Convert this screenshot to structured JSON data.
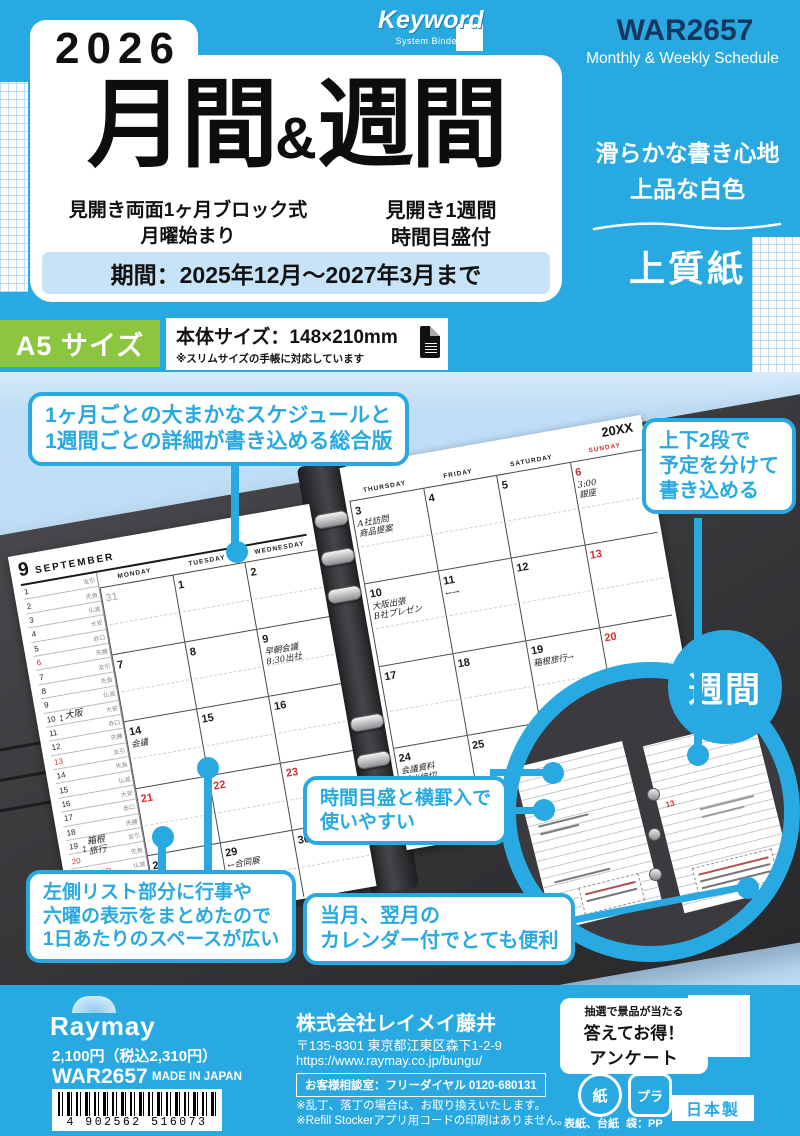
{
  "colors": {
    "accent": "#29A9E1",
    "green": "#8CC63F",
    "navy": "#17375F"
  },
  "brand": {
    "keyword": "Keyword",
    "keyword_sub": "System Binder",
    "raymay": "Raymay"
  },
  "header": {
    "year": "2026",
    "title_left": "月間",
    "title_amp": "&",
    "title_right": "週間",
    "product_code": "WAR2657",
    "product_subtitle": "Monthly & Weekly Schedule",
    "feature_left_1": "見開き両面1ヶ月ブロック式",
    "feature_left_2": "月曜始まり",
    "feature_right_1": "見開き1週間",
    "feature_right_2": "時間目盛付",
    "period": "期間：2025年12月～2027年3月まで"
  },
  "paper": {
    "line1": "滑らかな書き心地",
    "line2": "上品な白色",
    "type": "上質紙"
  },
  "size": {
    "badge": "A5 サイズ",
    "body": "本体サイズ：148×210mm",
    "note": "※スリムサイズの手帳に対応しています"
  },
  "callouts": {
    "c1": [
      "1ヶ月ごとの大まかなスケジュールと",
      "1週間ごとの詳細が書き込める総合版"
    ],
    "c2": [
      "上下2段で",
      "予定を分けて",
      "書き込める"
    ],
    "c3": [
      "時間目盛と横罫入で",
      "使いやすい"
    ],
    "c4": [
      "左側リスト部分に行事や",
      "六曜の表示をまとめたので",
      "1日あたりのスペースが広い"
    ],
    "c5": [
      "当月、翌月の",
      "カレンダー付でとても便利"
    ],
    "weekly_label": "週間"
  },
  "calendar": {
    "month_num": "9",
    "month_name": "SEPTEMBER",
    "year_label": "20XX",
    "day_headers_left": [
      "MONDAY",
      "TUESDAY",
      "WEDNESDAY"
    ],
    "day_headers_right": [
      "THURSDAY",
      "FRIDAY",
      "SATURDAY",
      "SUNDAY"
    ],
    "rokuyo": [
      "先勝",
      "友引",
      "先負",
      "仏滅",
      "大安",
      "赤口"
    ],
    "list_days": 30,
    "list_red": [
      6,
      13,
      20,
      21,
      22,
      23,
      27
    ],
    "list_events": [
      {
        "day": 21,
        "text": "敬老の日"
      },
      {
        "day": 22,
        "text": "国民の休日"
      },
      {
        "day": 23,
        "text": "秋分の日"
      }
    ],
    "list_spans": [
      {
        "from": 10,
        "text": "大阪"
      },
      {
        "from": 19,
        "text": "箱根\n旅行"
      }
    ],
    "grid_left": [
      [
        {
          "d": "31",
          "dim": true
        },
        {
          "d": "1"
        },
        {
          "d": "2"
        }
      ],
      [
        {
          "d": "7"
        },
        {
          "d": "8"
        },
        {
          "d": "9",
          "note": "早朝会議\n8:30出社"
        }
      ],
      [
        {
          "d": "14",
          "note": "会議"
        },
        {
          "d": "15"
        },
        {
          "d": "16"
        }
      ],
      [
        {
          "d": "21",
          "red": true
        },
        {
          "d": "22",
          "red": true
        },
        {
          "d": "23",
          "red": true
        }
      ],
      [
        {
          "d": "28"
        },
        {
          "d": "29",
          "note": "←合同展"
        },
        {
          "d": "30"
        }
      ]
    ],
    "grid_right": [
      [
        {
          "d": "3",
          "note": "A社訪問\n商品提案"
        },
        {
          "d": "4"
        },
        {
          "d": "5"
        },
        {
          "d": "6",
          "red": true,
          "note": "3:00\n銀座"
        }
      ],
      [
        {
          "d": "10",
          "note": "大阪出張\nB社プレゼン"
        },
        {
          "d": "11",
          "note": "←→"
        },
        {
          "d": "12"
        },
        {
          "d": "13",
          "red": true
        }
      ],
      [
        {
          "d": "17"
        },
        {
          "d": "18"
        },
        {
          "d": "19",
          "note": "箱根旅行→"
        },
        {
          "d": "20",
          "red": true
        }
      ],
      [
        {
          "d": "24",
          "note": "会議資料\n提出締切"
        },
        {
          "d": "25"
        },
        {
          "d": "26"
        },
        {
          "d": "27",
          "red": true,
          "note": "コンサート\n2:00会場"
        }
      ]
    ]
  },
  "footer": {
    "price": "2,100円（税込2,310円）",
    "code": "WAR2657",
    "made": "MADE IN JAPAN",
    "barcode": "4 902562 516073",
    "company": "株式会社レイメイ藤井",
    "address": "〒135-8301 東京都江東区森下1-2-9",
    "url": "https://www.raymay.co.jp/bungu/",
    "support": "お客様相談室：フリーダイヤル 0120-680131",
    "note1": "※乱丁、落丁の場合は、お取り換えいたします。",
    "note2": "※Refill Stockerアプリ用コードの印刷はありません。",
    "survey1": "抽選で景品が当たる",
    "survey2": "答えてお得！",
    "survey3": "アンケート",
    "recycle_paper": "紙",
    "recycle_paper_label": "表紙、台紙",
    "recycle_plastic": "プラ",
    "recycle_plastic_label": "袋：PP",
    "made_in": "日本製"
  }
}
